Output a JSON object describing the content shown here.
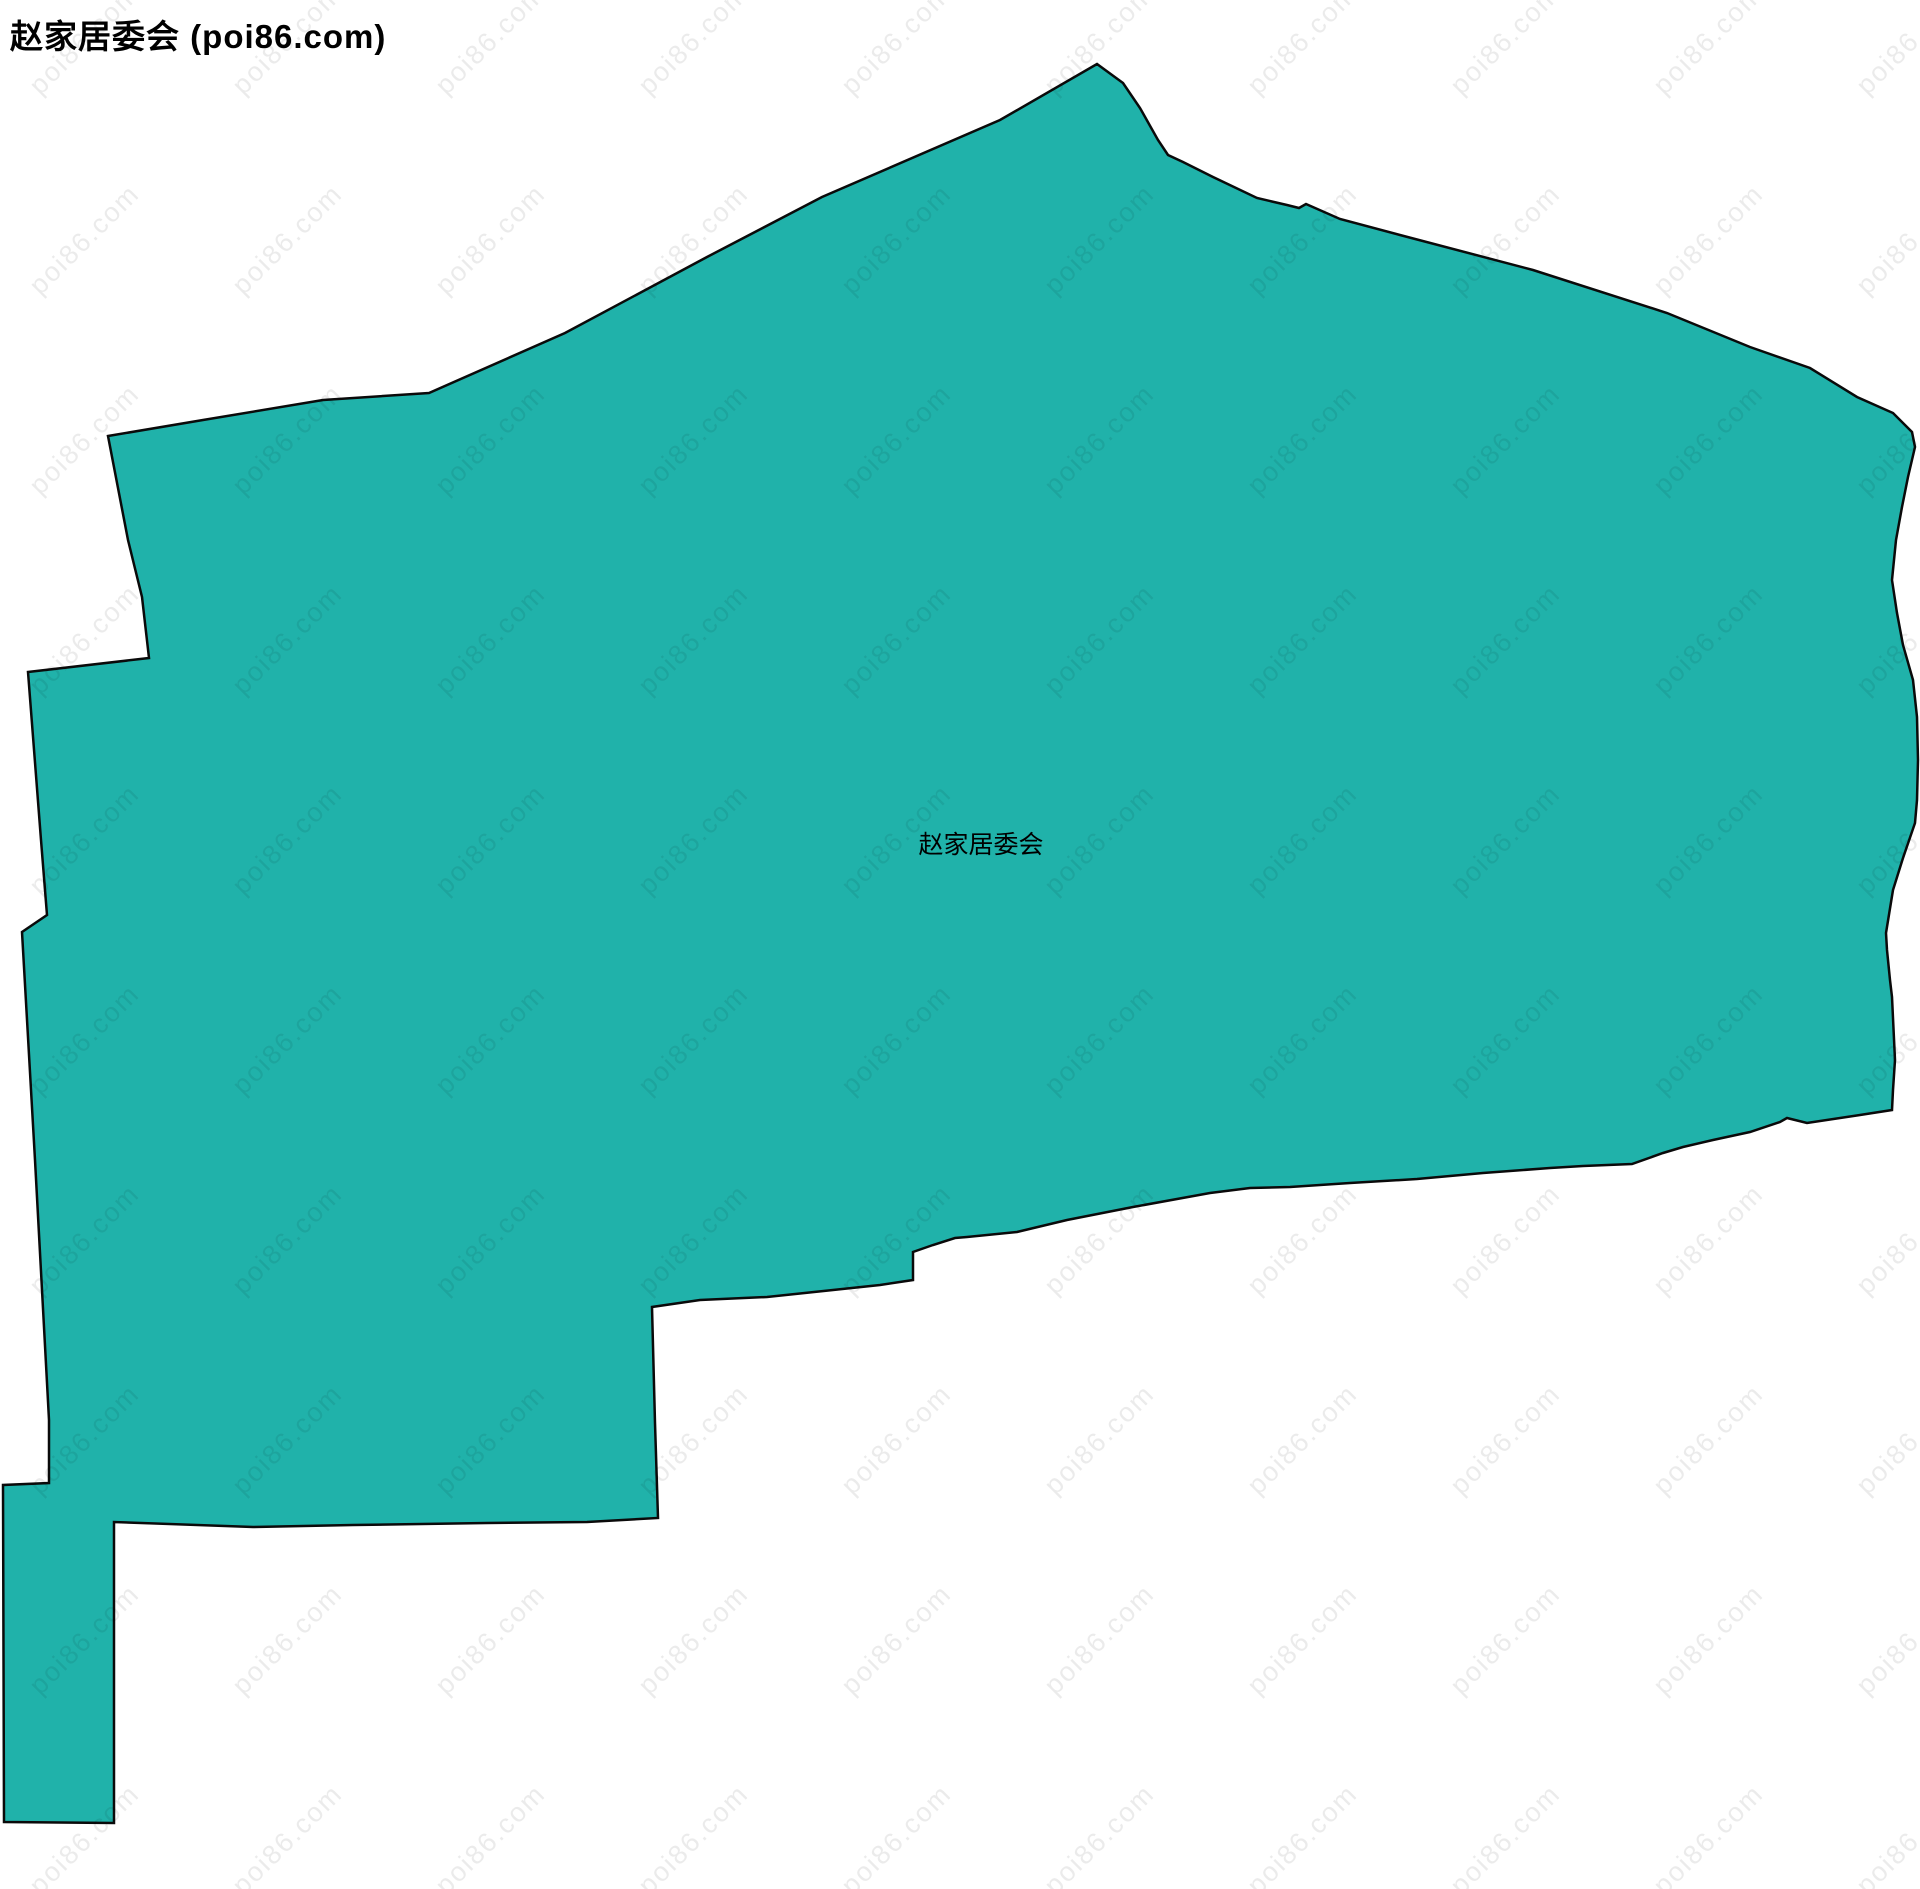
{
  "page_title": "赵家居委会 (poi86.com)",
  "map": {
    "region_label": "赵家居委会",
    "watermark_text": "poi86.com",
    "fill_color": "#20B2AA",
    "border_color": "#0a0a0a",
    "background_color": "#ffffff",
    "watermark_color": "#000000",
    "watermark_opacity": 0.08,
    "canvas": {
      "width": 1920,
      "height": 1889
    },
    "label_position": {
      "x": 981,
      "y": 843
    },
    "region_points": [
      [
        108,
        436
      ],
      [
        203,
        420
      ],
      [
        323,
        400
      ],
      [
        429,
        393
      ],
      [
        565,
        333
      ],
      [
        707,
        257
      ],
      [
        822,
        197
      ],
      [
        1000,
        120
      ],
      [
        1097,
        64
      ],
      [
        1123,
        83
      ],
      [
        1140,
        108
      ],
      [
        1158,
        140
      ],
      [
        1168,
        155
      ],
      [
        1183,
        162
      ],
      [
        1213,
        177
      ],
      [
        1257,
        198
      ],
      [
        1287,
        205
      ],
      [
        1299,
        208
      ],
      [
        1306,
        204
      ],
      [
        1340,
        219
      ],
      [
        1400,
        235
      ],
      [
        1533,
        270
      ],
      [
        1667,
        313
      ],
      [
        1750,
        347
      ],
      [
        1810,
        368
      ],
      [
        1857,
        397
      ],
      [
        1893,
        413
      ],
      [
        1912,
        432
      ],
      [
        1915,
        447
      ],
      [
        1908,
        477
      ],
      [
        1902,
        507
      ],
      [
        1896,
        540
      ],
      [
        1892,
        580
      ],
      [
        1897,
        613
      ],
      [
        1903,
        645
      ],
      [
        1913,
        680
      ],
      [
        1917,
        717
      ],
      [
        1918,
        760
      ],
      [
        1917,
        800
      ],
      [
        1915,
        823
      ],
      [
        1903,
        858
      ],
      [
        1893,
        890
      ],
      [
        1886,
        933
      ],
      [
        1887,
        950
      ],
      [
        1890,
        980
      ],
      [
        1892,
        997
      ],
      [
        1895,
        1060
      ],
      [
        1893,
        1090
      ],
      [
        1892,
        1110
      ],
      [
        1860,
        1115
      ],
      [
        1807,
        1123
      ],
      [
        1787,
        1118
      ],
      [
        1780,
        1122
      ],
      [
        1750,
        1132
      ],
      [
        1713,
        1140
      ],
      [
        1683,
        1147
      ],
      [
        1663,
        1153
      ],
      [
        1632,
        1164
      ],
      [
        1583,
        1166
      ],
      [
        1550,
        1168
      ],
      [
        1483,
        1173
      ],
      [
        1417,
        1179
      ],
      [
        1350,
        1183
      ],
      [
        1290,
        1187
      ],
      [
        1250,
        1188
      ],
      [
        1210,
        1193
      ],
      [
        1133,
        1207
      ],
      [
        1067,
        1220
      ],
      [
        1017,
        1232
      ],
      [
        967,
        1237
      ],
      [
        955,
        1238
      ],
      [
        933,
        1245
      ],
      [
        913,
        1252
      ],
      [
        913,
        1280
      ],
      [
        880,
        1285
      ],
      [
        833,
        1290
      ],
      [
        767,
        1297
      ],
      [
        700,
        1300
      ],
      [
        652,
        1307
      ],
      [
        655,
        1423
      ],
      [
        658,
        1518
      ],
      [
        587,
        1522
      ],
      [
        487,
        1523
      ],
      [
        353,
        1525
      ],
      [
        253,
        1527
      ],
      [
        114,
        1522
      ],
      [
        114,
        1823
      ],
      [
        4,
        1822
      ],
      [
        3,
        1485
      ],
      [
        49,
        1483
      ],
      [
        49,
        1420
      ],
      [
        35,
        1160
      ],
      [
        22,
        932
      ],
      [
        47,
        915
      ],
      [
        41,
        840
      ],
      [
        28,
        672
      ],
      [
        149,
        658
      ],
      [
        142,
        597
      ],
      [
        128,
        540
      ]
    ]
  }
}
